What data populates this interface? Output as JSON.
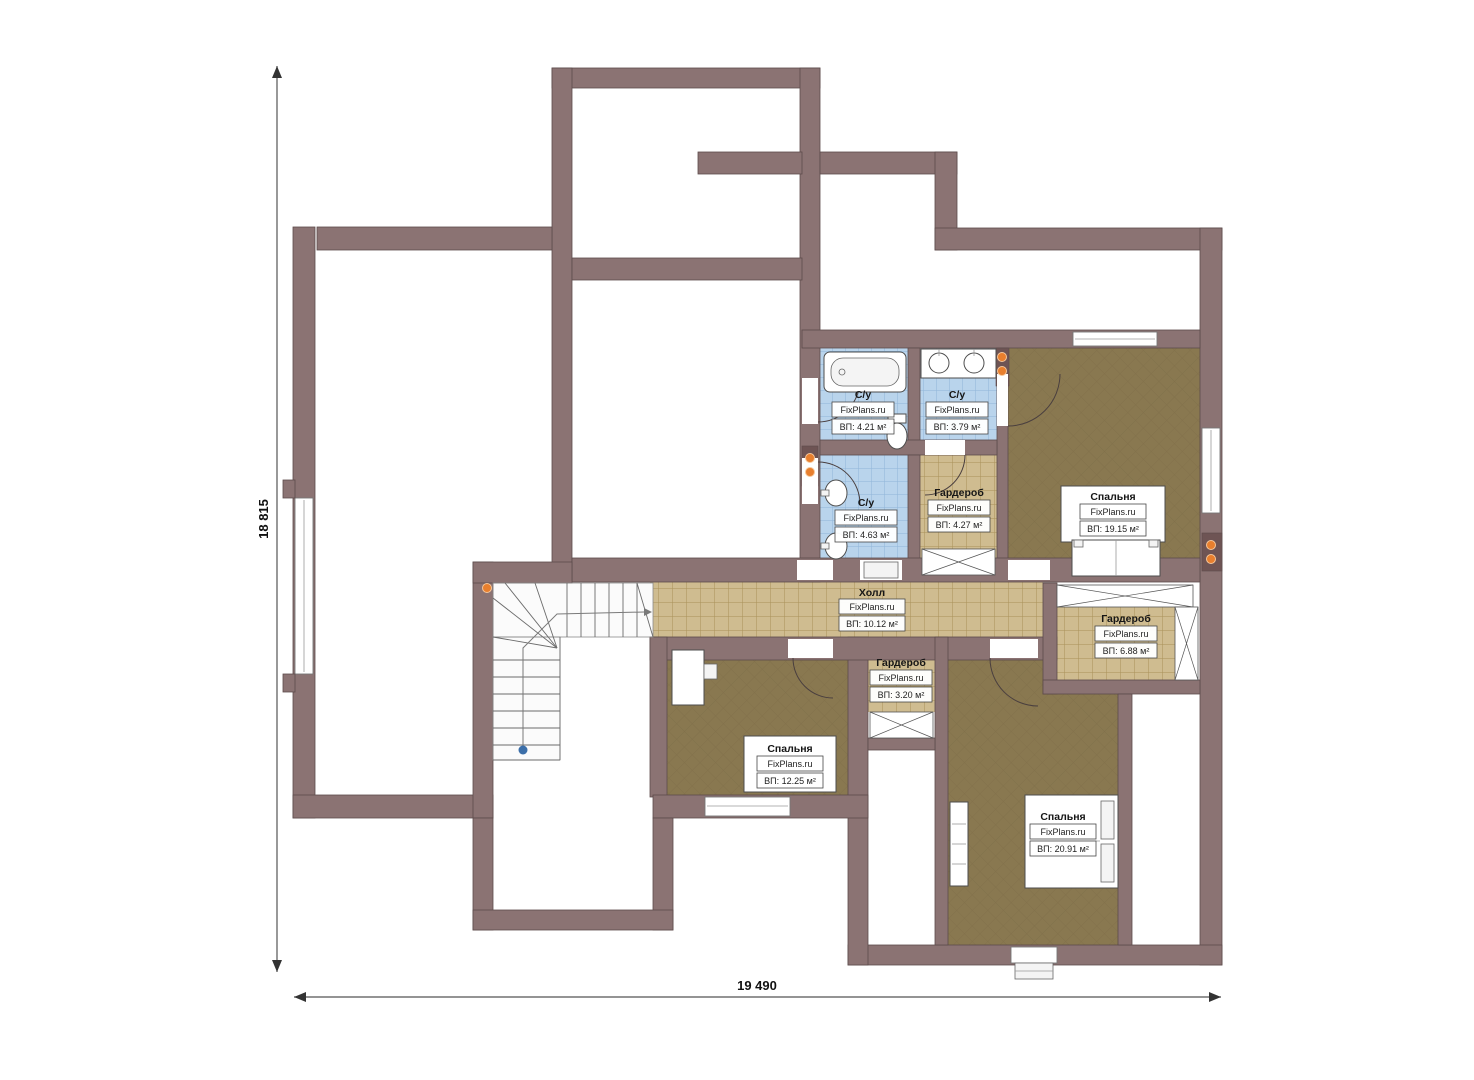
{
  "plan": {
    "watermark": "FixPlans.ru",
    "dimension_height": "18 815",
    "dimension_width": "19 490",
    "rooms": {
      "bath_1": {
        "name": "С/у",
        "area": "ВП: 4.21 м²"
      },
      "bath_2": {
        "name": "С/у",
        "area": "ВП: 3.79 м²"
      },
      "bath_3": {
        "name": "С/у",
        "area": "ВП: 4.63 м²"
      },
      "wardrobe_1": {
        "name": "Гардероб",
        "area": "ВП: 4.27 м²"
      },
      "wardrobe_2": {
        "name": "Гардероб",
        "area": "ВП: 6.88 м²"
      },
      "wardrobe_3": {
        "name": "Гардероб",
        "area": "ВП: 3.20 м²"
      },
      "hall": {
        "name": "Холл",
        "area": "ВП: 10.12 м²"
      },
      "bedroom_1": {
        "name": "Спальня",
        "area": "ВП: 19.15 м²"
      },
      "bedroom_2": {
        "name": "Спальня",
        "area": "ВП: 12.25 м²"
      },
      "bedroom_3": {
        "name": "Спальня",
        "area": "ВП: 20.91 м²"
      }
    },
    "colors": {
      "wall": "#8b7373",
      "wall_stroke": "#5d4b4b",
      "bedroom_floor": "#897850",
      "tile_floor": "#cfbc90",
      "bath_floor": "#b9d4ec",
      "accent_dot": "#e87f2e",
      "stair_dot": "#3c6fa9"
    }
  }
}
